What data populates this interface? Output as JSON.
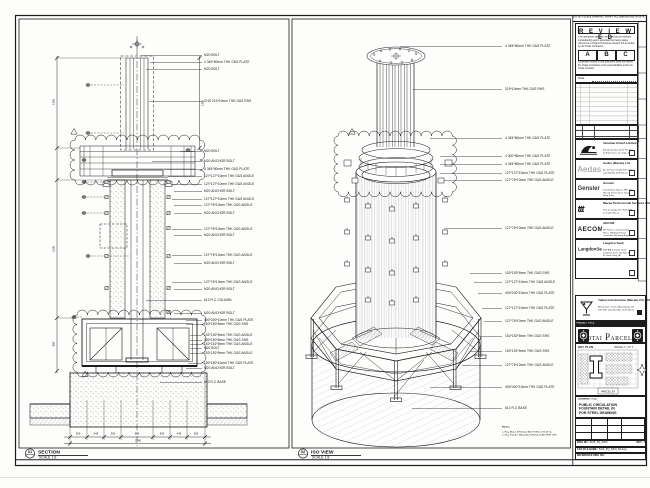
{
  "sheet": {
    "bg": "#fdfdfc",
    "line": "#1c1c1c",
    "accent": "#1d1d1d"
  },
  "views": {
    "section": {
      "bubble": "01",
      "title": "SECTION",
      "scale": "SCALE 1:8",
      "callouts": [
        {
          "y": 54,
          "lx": 141,
          "t": "M20 BOLT"
        },
        {
          "y": 61,
          "lx": 150,
          "t": "4 345*50mm THK G&S PLATE"
        },
        {
          "y": 68,
          "lx": 146,
          "t": "M20 BOLT"
        },
        {
          "y": 100,
          "lx": 149,
          "t": "CHS 219*10mm THK G&S RHS"
        },
        {
          "y": 150,
          "lx": 180,
          "t": "M20 BOLT"
        },
        {
          "y": 160,
          "lx": 152,
          "t": "M20 ANCHOR BOLT"
        },
        {
          "y": 168,
          "lx": 164,
          "t": "4 345*50mm THK G&S PLATE"
        },
        {
          "y": 175,
          "lx": 168,
          "t": "127*127*10mm THK G&S ANGLE"
        },
        {
          "y": 183,
          "lx": 172,
          "t": "127*127*10mm THK G&S ANGLE"
        },
        {
          "y": 190,
          "lx": 174,
          "t": "M20 ANCHOR BOLT"
        },
        {
          "y": 198,
          "lx": 172,
          "t": "127*127*10mm THK G&S ANGLE"
        },
        {
          "y": 204,
          "lx": 174,
          "t": "127*76*10mm THK G&S ANGLE"
        },
        {
          "y": 212,
          "lx": 174,
          "t": "M20 ANCHOR BOLT"
        },
        {
          "y": 228,
          "lx": 172,
          "t": "127*76*10mm THK G&S ANGLE"
        },
        {
          "y": 234,
          "lx": 174,
          "t": "M20 ANCHOR BOLT"
        },
        {
          "y": 254,
          "lx": 172,
          "t": "127*76*10mm THK G&S ANGLE"
        },
        {
          "y": 262,
          "lx": 174,
          "t": "M20 ANCHOR BOLT"
        },
        {
          "y": 281,
          "lx": 172,
          "t": "127*76*10mm THK G&S ANGLE"
        },
        {
          "y": 288,
          "lx": 174,
          "t": "M20 ANCHOR BOLT"
        },
        {
          "y": 299,
          "lx": 146,
          "t": "610 R.C COLUMN"
        },
        {
          "y": 312,
          "lx": 174,
          "t": "M20 ANCHOR BOLT"
        },
        {
          "y": 319,
          "lx": 186,
          "t": "400*200*10mm THK G&S PLATE"
        },
        {
          "y": 323,
          "lx": 186,
          "t": "150*150*5mm THK G&S SHS"
        },
        {
          "y": 334,
          "lx": 190,
          "t": "152*152*5mm THK G&S ANGLE"
        },
        {
          "y": 339,
          "lx": 190,
          "t": "150*150*5mm THK G&S SHS"
        },
        {
          "y": 343,
          "lx": 190,
          "t": "152*152*5mm THK G&S ANGLE"
        },
        {
          "y": 347,
          "lx": 190,
          "t": "M20 BOLT"
        },
        {
          "y": 352,
          "lx": 190,
          "t": "152*152*5mm THK G&S ANGLE"
        },
        {
          "y": 362,
          "lx": 188,
          "t": "150*150*10mm THK G&S PLATE"
        },
        {
          "y": 367,
          "lx": 186,
          "t": "M20 ANCHOR BOLT"
        },
        {
          "y": 381,
          "lx": 160,
          "t": "610 R.C BASE"
        }
      ],
      "dims": [
        {
          "x": 78,
          "y": 433.5,
          "t": "300"
        },
        {
          "x": 95.5,
          "y": 433.5,
          "t": "445"
        },
        {
          "x": 112.5,
          "y": 433.5,
          "t": "300"
        },
        {
          "x": 137,
          "y": 433.5,
          "t": "650"
        },
        {
          "x": 161.5,
          "y": 433.5,
          "t": "300"
        },
        {
          "x": 178.5,
          "y": 433.5,
          "t": "445"
        },
        {
          "x": 196,
          "y": 433.5,
          "t": "300"
        },
        {
          "x": 137.5,
          "y": 440.5,
          "t": "2740"
        },
        {
          "x": 53.5,
          "y": 102,
          "t": "1350",
          "r": 1
        },
        {
          "x": 53.5,
          "y": 249,
          "t": "2100",
          "r": 1
        },
        {
          "x": 53.5,
          "y": 344,
          "t": "900",
          "r": 1
        },
        {
          "x": 202.5,
          "y": 103,
          "t": "1350",
          "r": 1
        }
      ]
    },
    "iso": {
      "bubble": "02",
      "title": "ISO VIEW",
      "scale": "SCALE 1:8",
      "callouts": [
        {
          "y": 45,
          "lx": 400,
          "t": "4 345*50mm THK G&S PLATE"
        },
        {
          "y": 88,
          "lx": 413,
          "t": "219*10mm THK G&S RHS"
        },
        {
          "y": 137,
          "lx": 430,
          "t": "4 345*50mm THK G&S PLATE"
        },
        {
          "y": 155,
          "lx": 440,
          "t": "4 300*50mm THK G&S PLATE"
        },
        {
          "y": 163,
          "lx": 440,
          "t": "4 345*50mm THK G&S PLATE"
        },
        {
          "y": 172,
          "lx": 440,
          "t": "127*127*10mm THK G&S PLATE"
        },
        {
          "y": 179,
          "lx": 444,
          "t": "127*76*10mm THK G&S ANGLE"
        },
        {
          "y": 227,
          "lx": 446,
          "t": "127*76*10mm THK G&S ANGLE"
        },
        {
          "y": 272,
          "lx": 470,
          "t": "152*152*5mm THK G&S SHS"
        },
        {
          "y": 281,
          "lx": 474,
          "t": "127*127*10mm THK G&S ANGLE"
        },
        {
          "y": 292,
          "lx": 478,
          "t": "400*200*10mm THK G&S PLATE"
        },
        {
          "y": 307,
          "lx": 482,
          "t": "127*127*10mm THK G&S PLATE"
        },
        {
          "y": 320,
          "lx": 484,
          "t": "127*76*10mm THK G&S ANGLE"
        },
        {
          "y": 335,
          "lx": 480,
          "t": "152*152*5mm THK G&S SHS"
        },
        {
          "y": 350,
          "lx": 470,
          "t": "152*152*5mm THK G&S SHS"
        },
        {
          "y": 364,
          "lx": 462,
          "t": "127*76*10mm THK G&S ANGLE"
        },
        {
          "y": 386,
          "lx": 430,
          "t": "400*400*10mm THK G&S PLATE"
        },
        {
          "y": 407,
          "lx": 412,
          "t": "610 R.C BASE"
        }
      ],
      "note_title": "NOTE:",
      "notes": [
        "1. ALL BOLT SHOULD BE FIXING ON SITE.",
        "2. ALL FILLET WELDED SHOULD BE 6mm THK."
      ]
    }
  },
  "titleblock": {
    "top_note": "DO NOT SCALE DRAWING. VERIFY ALL DIMENSIONS ON SITE.",
    "stamp": {
      "title": "R E V I E W E D",
      "para1": "This document has been reviewed by the relevant Consultant(s) and is accorded the below status referred to in Project Procedure Section 5.4 for action by the Trade Contractor.",
      "options": [
        "A",
        "B",
        "C"
      ],
      "para2": "Consultant review of this document does not relieve the Trade Contractor of its responsibilities under the Trade Contract.",
      "date_label": "Date :"
    },
    "rev_table": {
      "headers": [
        "REV",
        "DATE",
        "DESCRIPTION",
        "BY"
      ],
      "rows": [
        {
          "rev": "B",
          "date": "28.05.15",
          "desc": "ISSUED FOR APPROVAL",
          "by": "KC"
        },
        {
          "rev": "A",
          "date": "11.05.15",
          "desc": "ISSUED FOR APPROVAL",
          "by": "KC"
        }
      ]
    },
    "consultants": [
      {
        "logo_text": "",
        "name": "Venetian Orient Limited",
        "addr": "Estrada da Baía de N. Senhora da Esperança, s/n, Taipa, Macau"
      },
      {
        "logo_text": "Aedas",
        "name": "Aedas (Macau) Ltd.",
        "addr": "Av. da Praia Grande 409, China Law Building 21/F, Macau"
      },
      {
        "logo_text": "Gensler",
        "name": "Gensler",
        "addr": "Two Harbour Square 18/F, 180 Wai Yip Street, Kwun Tong, Hong Kong"
      },
      {
        "logo_text": "ttt",
        "name": "Macau Professional Services Ltd.",
        "addr": "Rua de Xangai 175, Edif. ACM 12 andar, Macau"
      },
      {
        "logo_text": "AECOM",
        "name": "AECOM",
        "addr": "8/F Tower 2, Grand Central Plaza, 138 Shatin Rural Committee Rd, Hong Kong"
      },
      {
        "logo_text": "LangdonSeah",
        "name": "Langdon Seah",
        "add r": "",
        "addr": "38/F AIA Kowloon Tower, Landmark East, 100 How Ming St, Kwun Tong, HK"
      }
    ],
    "contractor": {
      "name": "Yadea Construction (Macau) CO, LTD.",
      "addr": "Alameda Dr. Carlos d'Assumpção, No. 180, Edif. Tong Nam Ah, 12-E, Macau",
      "tel": "Tel: (853) 2875 3789   Fax: (853) 2875 3766"
    },
    "project_label": "PROJECT TITLE",
    "project_title": "Cotai Parcel 3",
    "keyplan": {
      "label": "KEY PLAN",
      "parcel_top": "PARCEL 1, LOT 2",
      "parcel_box": "PARCEL 3A"
    },
    "drawing": {
      "title_label": "DRAWING TITLE:",
      "title_lines": [
        "PUBLIC CIRCULATION",
        "FOUNTAIN DETAIL IN",
        "FOR STEEL DRAWING"
      ],
      "fields": [
        {
          "k": "DESIGNED",
          "v": "-",
          "k2": "SCALE",
          "v2": "AS SHOWN"
        },
        {
          "k": "CHECKED",
          "v": "-",
          "k2": "DATE",
          "v2": "JUN 2015"
        },
        {
          "k": "APPROVED",
          "v": "-",
          "k2": "SIZE",
          "v2": "A1 (841*594)"
        }
      ],
      "dwg_label": "DWG NO :",
      "dwg_no": "5106_PQ_5009",
      "rev_label": "REV :",
      "rev": "C",
      "cad_label": "CAD FILE NAME :",
      "cad_file": "5106_PQ_5009_R3.dwg",
      "ref_label": "REFERENCE DWG NO :"
    }
  }
}
